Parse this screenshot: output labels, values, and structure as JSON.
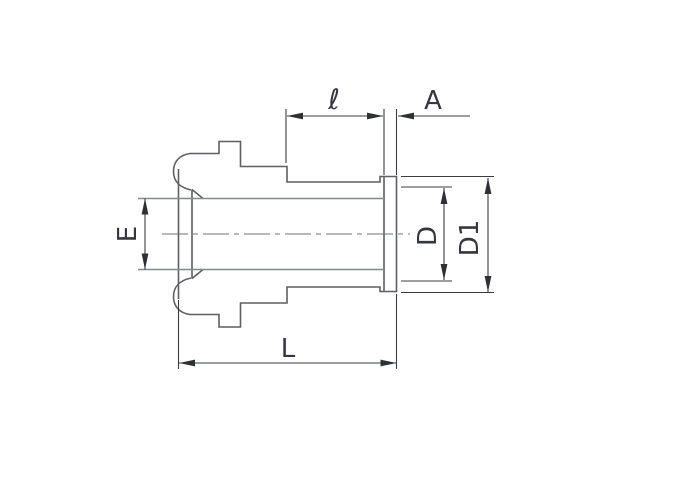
{
  "diagram": {
    "type": "technical-drawing",
    "view": "tube-fitting-gland-cross-section",
    "dimension_labels": {
      "ell": "ℓ",
      "a": "A",
      "e": "E",
      "d": "D",
      "d1": "D1",
      "l": "L"
    }
  },
  "colors": {
    "background": "#ffffff",
    "body_outline": "#5d5f63",
    "secondary_line": "#85878b",
    "dimension_line": "#3b3c40",
    "label_text": "#36373e"
  }
}
